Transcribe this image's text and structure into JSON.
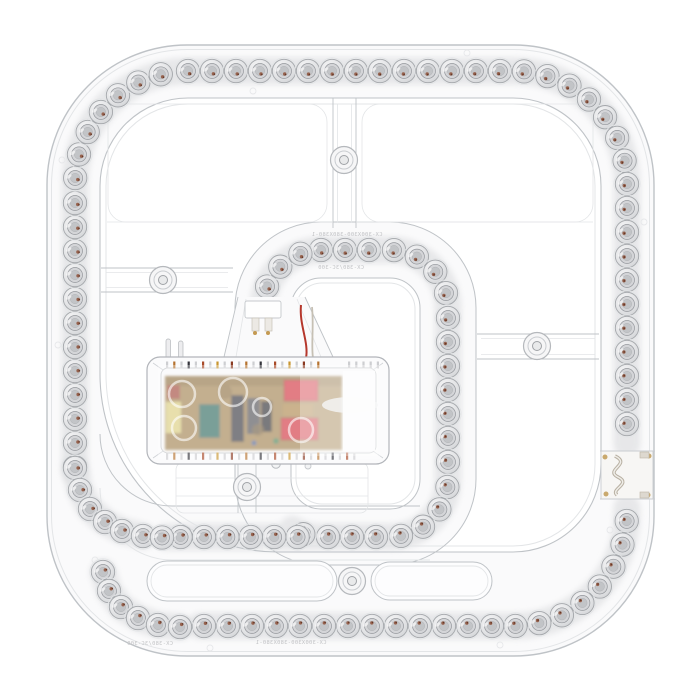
{
  "scene": {
    "type": "product-photo",
    "subject": "Square LED ceiling light retrofit module with spiral rings of LED lenses and a central driver unit",
    "background": "#ffffff"
  },
  "colors": {
    "plastic_fill": "#fafafb",
    "edge_strong": "#bfc3c7",
    "edge_soft": "#e3e5e7",
    "channel_shadow": "#d8d9db",
    "lens_rim": "#a4a7ab",
    "lens_mid": "#d4d5d8",
    "lens_core": "#c2c4c7",
    "led_chip": "#8b4a30",
    "driver_shell": "#fbfbfc",
    "pcb": "#9b7a45",
    "transformer_red": "#cf2532",
    "capacitor_teal": "#216052",
    "film_cap_yellow": "#d9cb74",
    "electrolytic_dark": "#2b2b30",
    "maroon_component": "#9c3a2e",
    "wire_red": "#b5372c",
    "solder_tan": "#c9a96e"
  },
  "markings": {
    "inner_top_line1": "CX-300X300-380X380-1",
    "inner_top_line2": "CX-380/3C-300",
    "bottom_line1": "CX-300X300-380X380-1",
    "bottom_line2": "CX-380/3C-300"
  }
}
